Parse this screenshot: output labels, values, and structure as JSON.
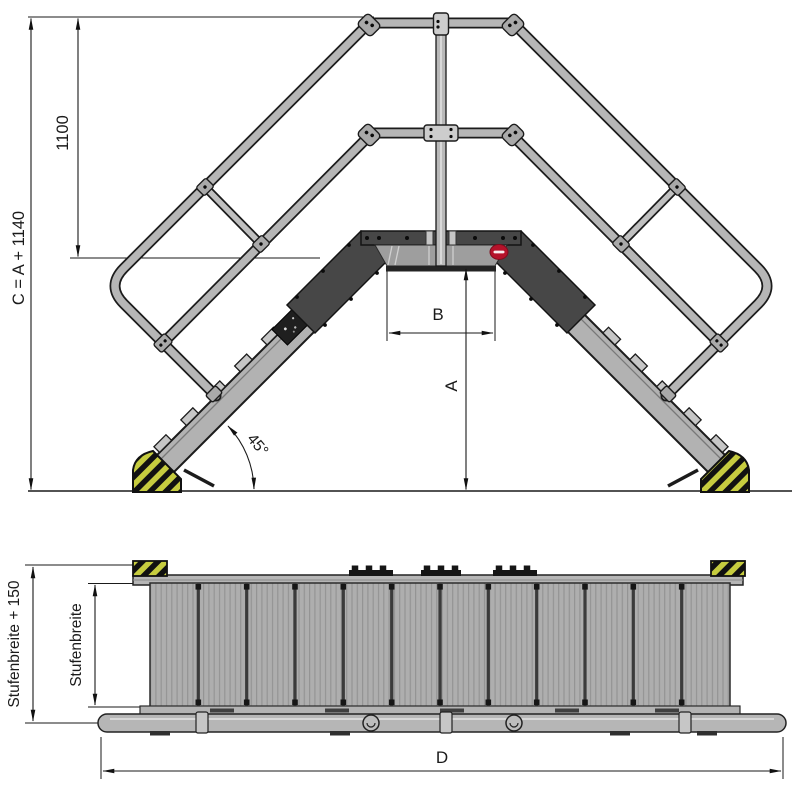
{
  "drawing": {
    "type": "crossover-stairway-technical-drawing",
    "front_view": {
      "dim_total_height": "C = A + 1140",
      "dim_guardrail_height": "1100",
      "dim_platform_clearance_width": "B",
      "dim_platform_height": "A",
      "dim_incline_angle": "45°",
      "steps_per_side": 5
    },
    "plan_view": {
      "dim_outer_width": "Stufenbreite + 150",
      "dim_step_width": "Stufenbreite",
      "dim_total_length": "D",
      "tread_panels": 12
    },
    "colors": {
      "ink": "#1a1a1a",
      "outline": "#1c1c1c",
      "tube": "#b6b6b6",
      "stringer": "#b2b2b2",
      "clamp": "#a9a9a9",
      "clamp-light": "#cdcdcd",
      "plate": "#474747",
      "fascia": "#9e9e9e",
      "hazard-yellow": "#c6cc3f",
      "tread": "#aeaeae",
      "brand-red": "#b5122a"
    }
  }
}
